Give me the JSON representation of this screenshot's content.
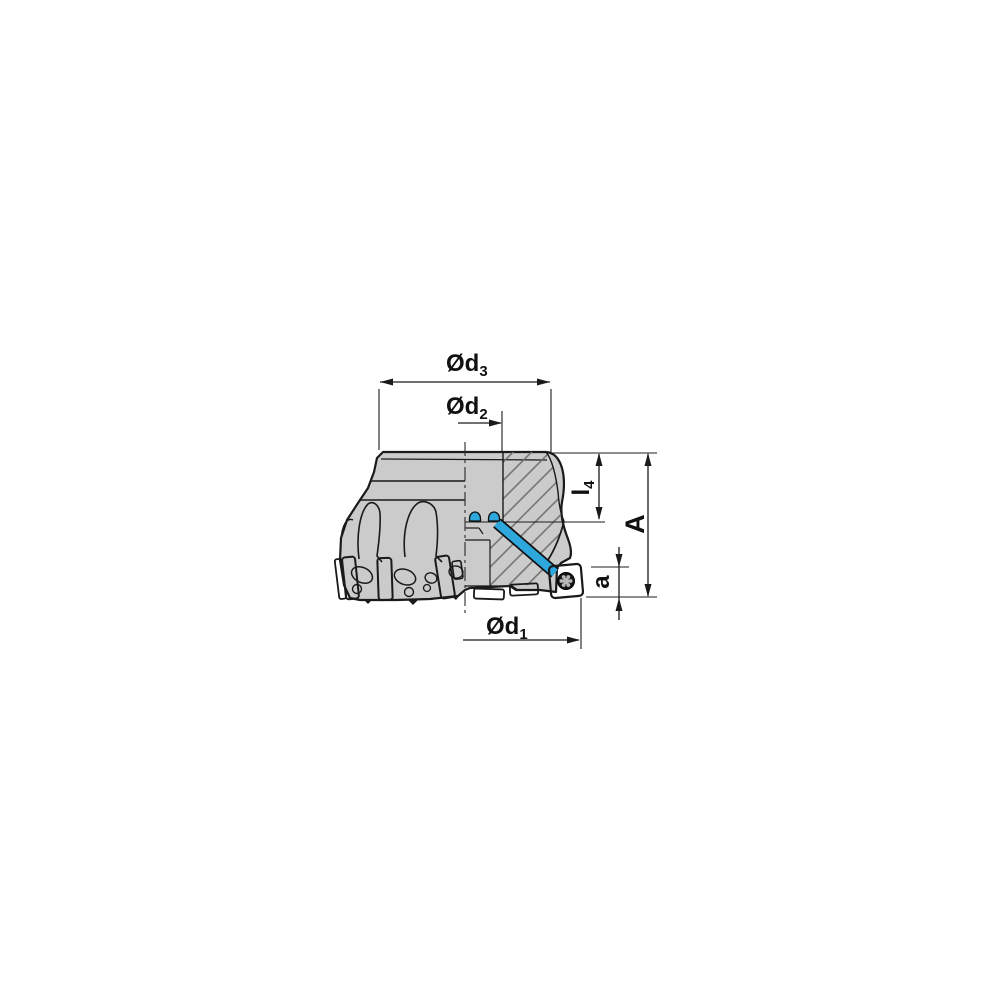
{
  "labels": {
    "d3": {
      "base": "Ød",
      "sub": "3"
    },
    "d2": {
      "base": "Ød",
      "sub": "2"
    },
    "d1": {
      "base": "Ød",
      "sub": "1"
    },
    "l4": {
      "base": "l",
      "sub": "4"
    },
    "A": {
      "base": "A",
      "sub": ""
    },
    "a": {
      "base": "a",
      "sub": ""
    }
  },
  "colors": {
    "insert_yellow": "#FFD200",
    "coolant_blue": "#2EA7DC",
    "body_gray": "#CBCBCB",
    "hatch_line": "#6E6E6E",
    "outline_black": "#1A1A1A",
    "screw_dark": "#161616",
    "screw_star": "#B9B9B9"
  }
}
